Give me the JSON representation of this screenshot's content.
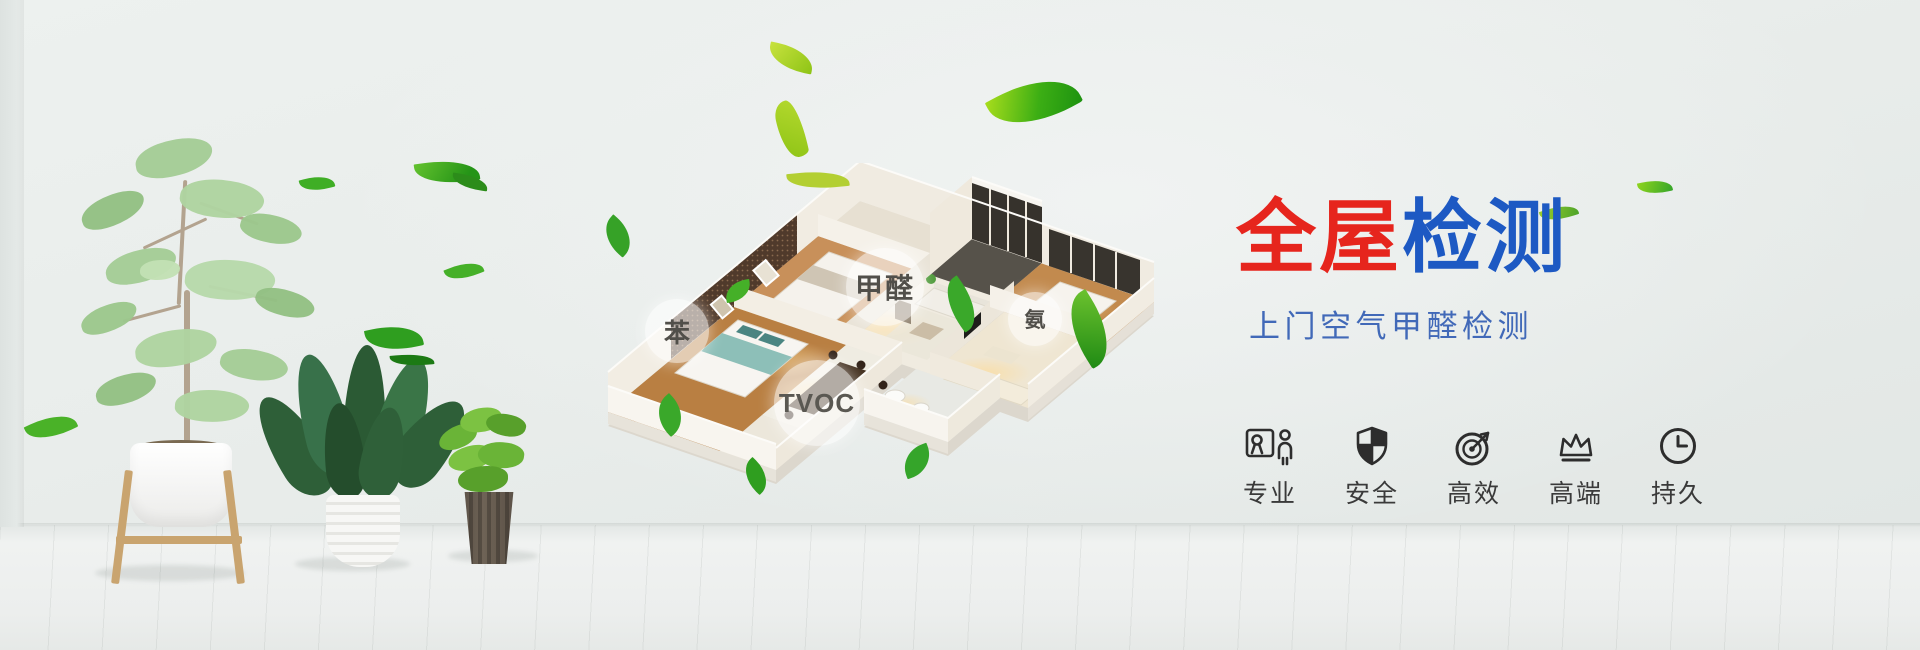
{
  "banner": {
    "title_red": "全屋",
    "title_blue": "检测",
    "subtitle": "上门空气甲醛检测"
  },
  "house_model": {
    "labels": {
      "formaldehyde": "甲醛",
      "benzene": "苯",
      "ammonia": "氨",
      "tvoc": "TVOC"
    }
  },
  "features": [
    {
      "icon": "certificate-person-icon",
      "label": "专业"
    },
    {
      "icon": "shield-icon",
      "label": "安全"
    },
    {
      "icon": "gauge-icon",
      "label": "高效"
    },
    {
      "icon": "crown-icon",
      "label": "高端"
    },
    {
      "icon": "clock-icon",
      "label": "持久"
    }
  ],
  "colors": {
    "title_red": "#e6251d",
    "title_blue": "#1d59c3",
    "subtitle_blue": "#4169b8",
    "feature_icon": "#2d2d2d",
    "feature_label": "#3a3a3a",
    "leaf_green": "#3aa82a",
    "wall_background": "#e9edeb"
  }
}
